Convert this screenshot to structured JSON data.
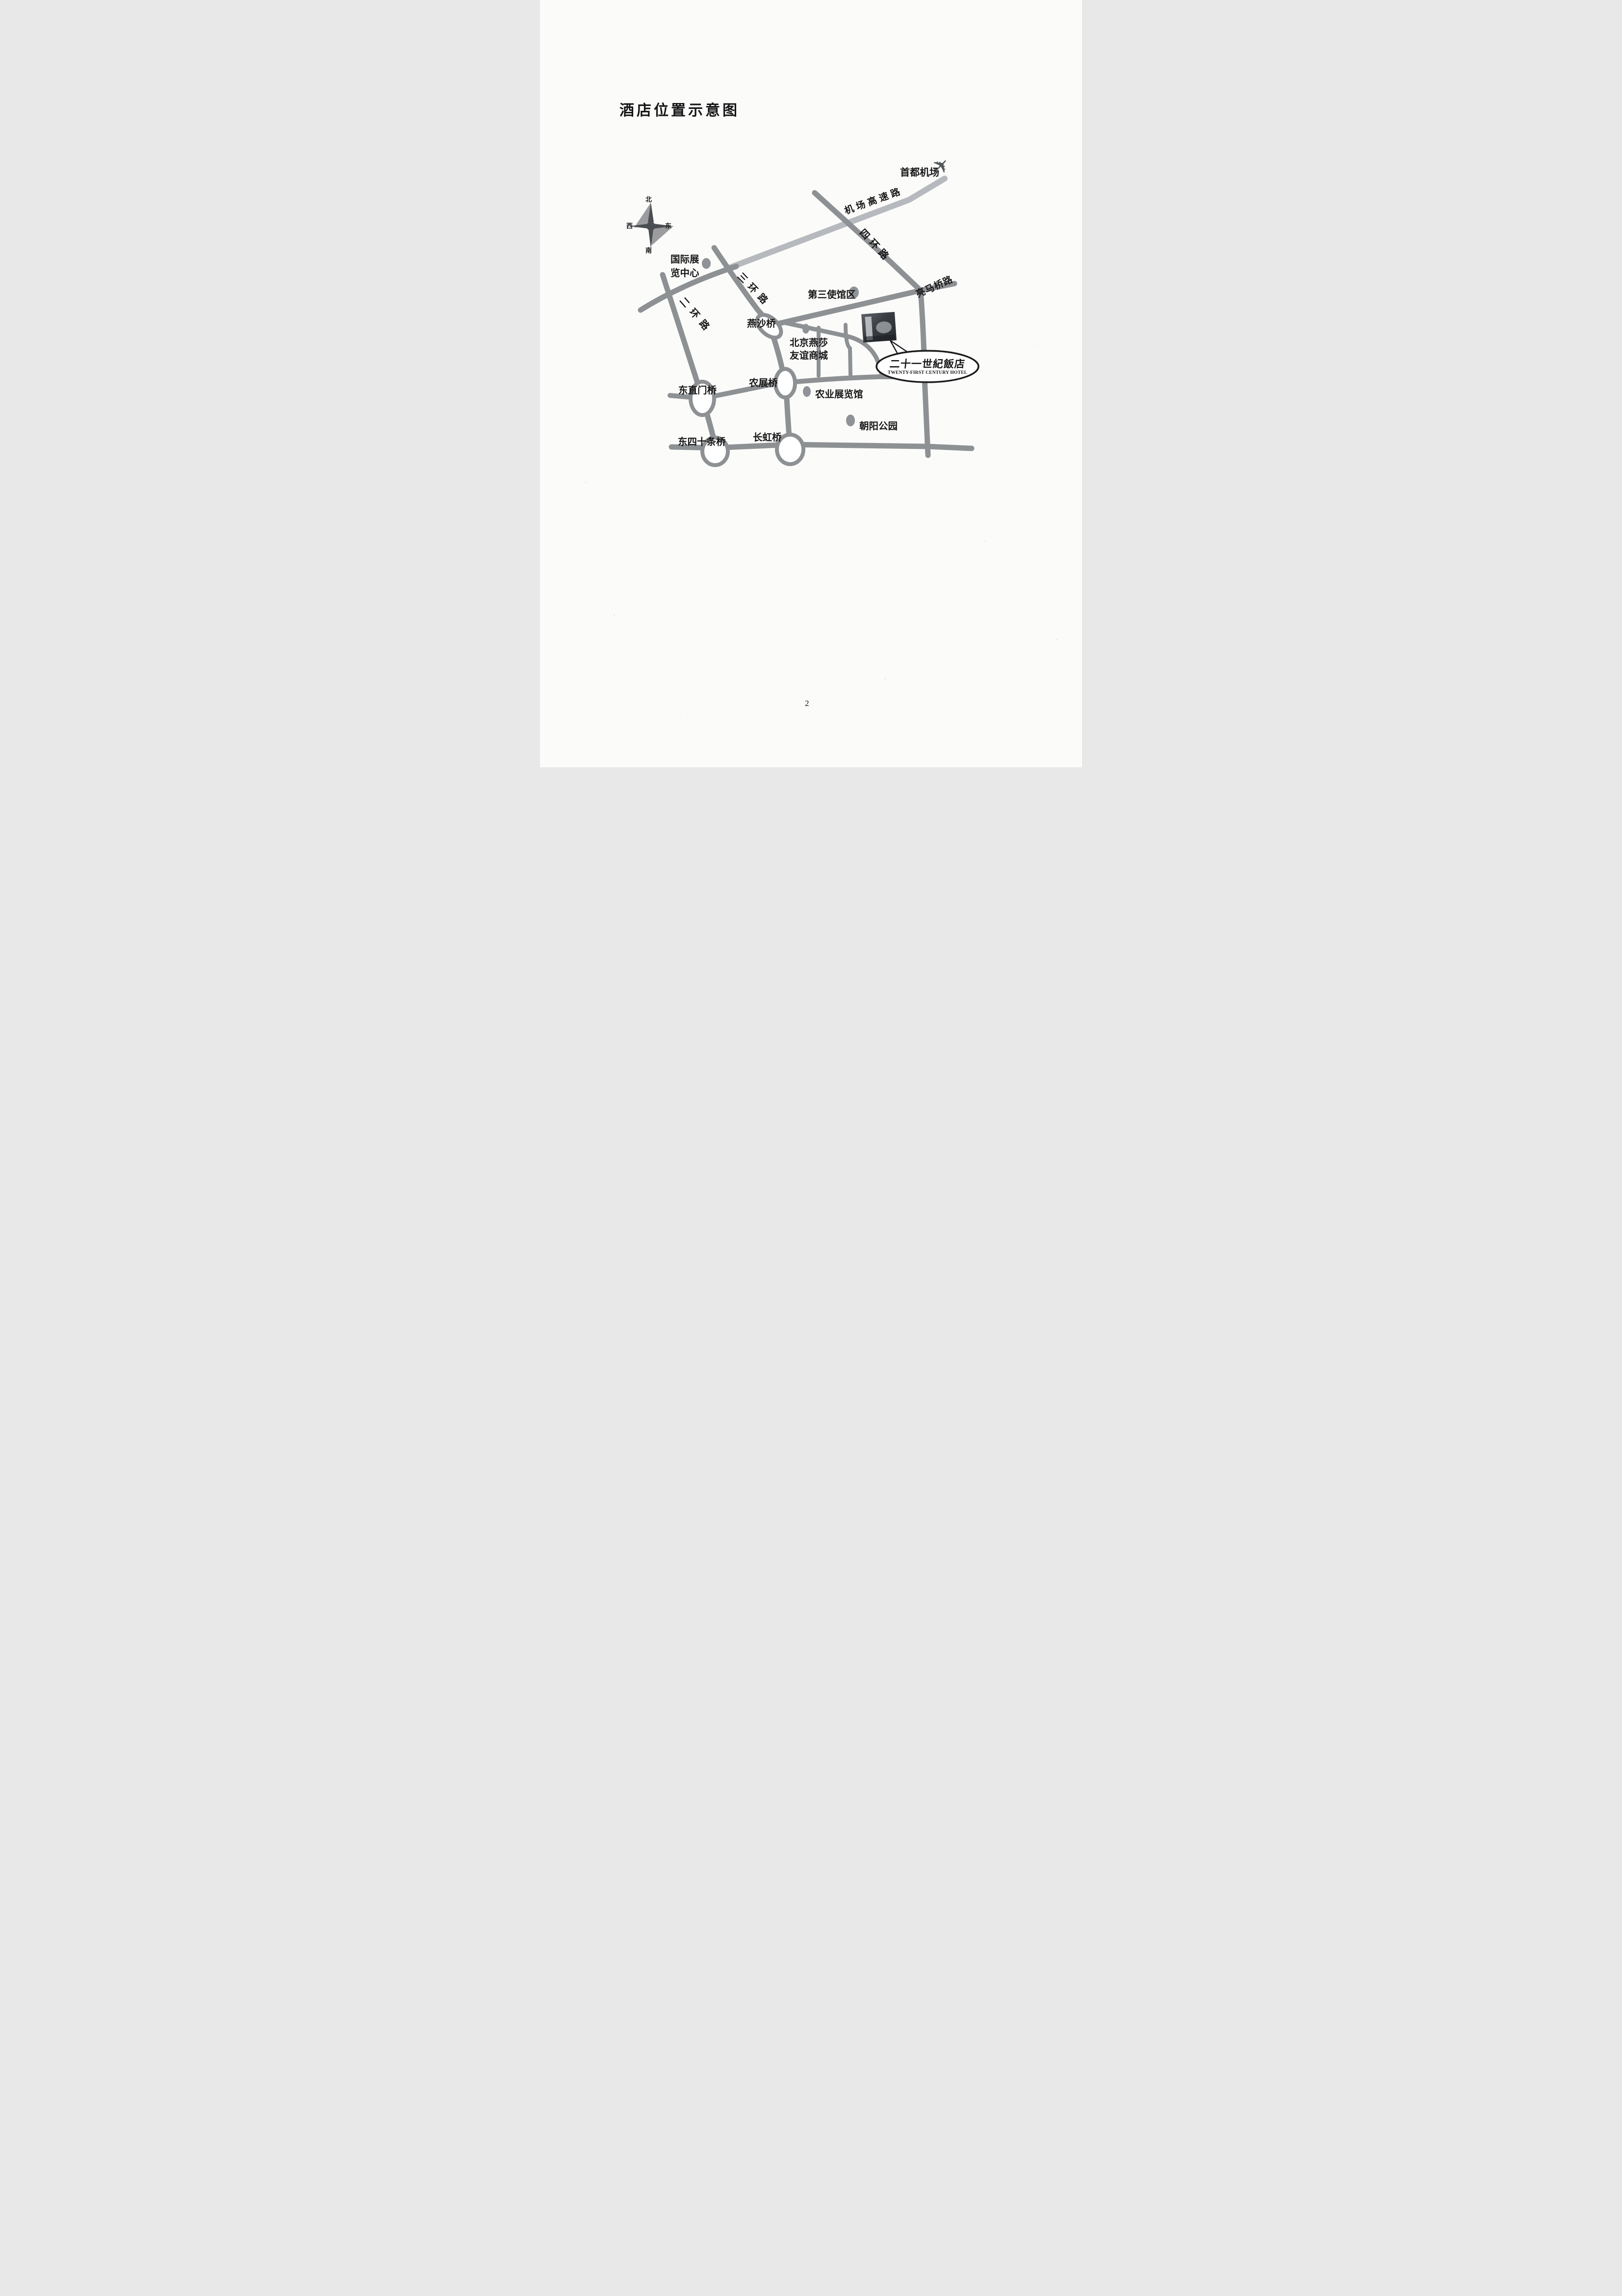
{
  "page": {
    "title": "酒店位置示意图",
    "page_number": "2"
  },
  "compass": {
    "north": "北",
    "south": "南",
    "west": "西",
    "east": "东"
  },
  "airport": {
    "label": "首都机场",
    "icon": "airplane"
  },
  "roads": {
    "airport_expressway": "机场高速路",
    "fourth_ring": "四环路",
    "third_ring": "三环路",
    "second_ring": "二环路",
    "liangmaqiao_road": "亮马桥路"
  },
  "places": {
    "intl_exhibition_line1": "国际展",
    "intl_exhibition_line2": "览中心",
    "embassy_district": "第三使馆区",
    "yansha_mall_line1": "北京燕莎",
    "yansha_mall_line2": "友谊商城",
    "agriculture_hall": "农业展览馆",
    "chaoyang_park": "朝阳公园"
  },
  "bridges": {
    "yansha": "燕沙桥",
    "dongzhimen": "东直门桥",
    "nongzhan": "农展桥",
    "dongsishitiao": "东四十条桥",
    "changhong": "长虹桥"
  },
  "hotel": {
    "name_cn": "二十一世紀飯店",
    "name_en": "TWENTY-FIRST CENTURY HOTEL"
  },
  "colors": {
    "road_gray": "#8e9194",
    "expressway_gray": "#b6b9bd",
    "ink": "#161616"
  }
}
